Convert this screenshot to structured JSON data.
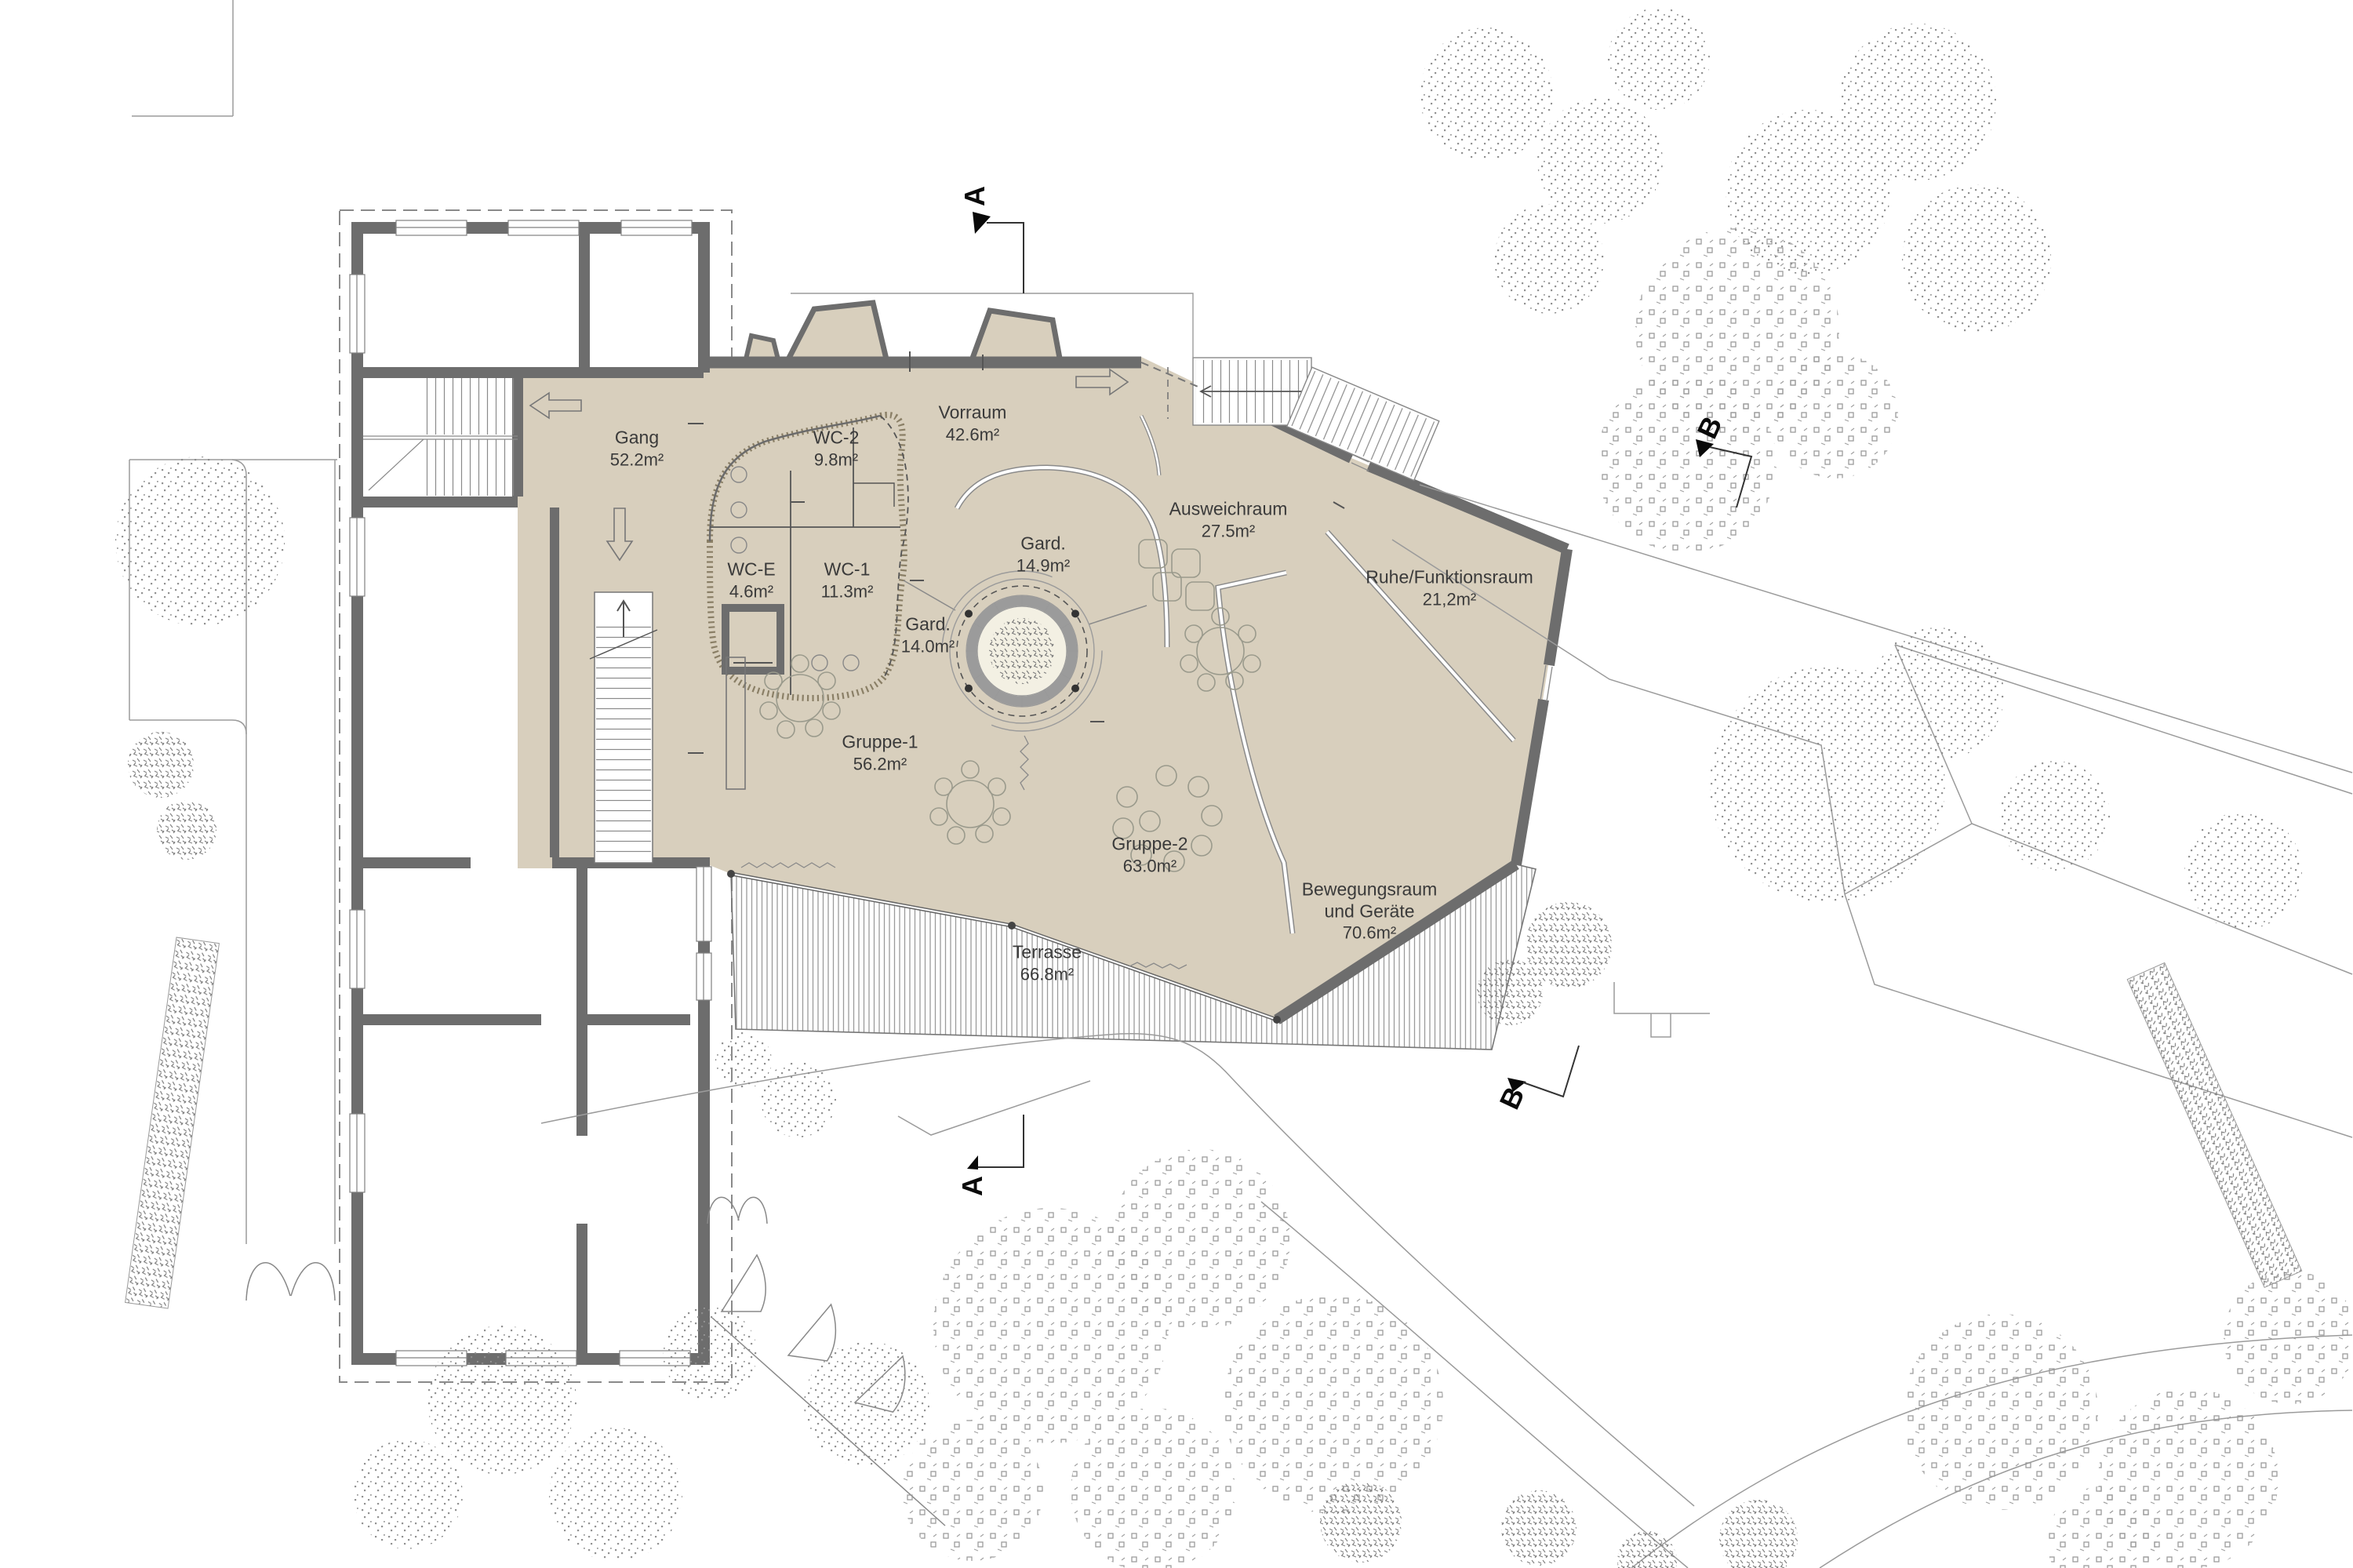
{
  "rooms": [
    {
      "name": "Gang",
      "name2": "",
      "area": "52.2m²"
    },
    {
      "name": "WC-2",
      "name2": "",
      "area": "9.8m²"
    },
    {
      "name": "WC-E",
      "name2": "",
      "area": "4.6m²"
    },
    {
      "name": "WC-1",
      "name2": "",
      "area": "11.3m²"
    },
    {
      "name": "Gard.",
      "name2": "",
      "area": "14.0m²"
    },
    {
      "name": "Gard.",
      "name2": "",
      "area": "14.9m²"
    },
    {
      "name": "Vorraum",
      "name2": "",
      "area": "42.6m²"
    },
    {
      "name": "Ausweichraum",
      "name2": "",
      "area": "27.5m²"
    },
    {
      "name": "Ruhe/Funktionsraum",
      "name2": "",
      "area": "21,2m²"
    },
    {
      "name": "Gruppe-1",
      "name2": "",
      "area": "56.2m²"
    },
    {
      "name": "Gruppe-2",
      "name2": "",
      "area": "63.0m²"
    },
    {
      "name": "Bewegungsraum",
      "name2": "und Geräte",
      "area": "70.6m²"
    },
    {
      "name": "Terrasse",
      "name2": "",
      "area": "66.8m²"
    }
  ],
  "markers": {
    "a": "A",
    "b": "B"
  },
  "colors": {
    "floor_beige": "#d8cfbd",
    "wall_gray": "#6d6d6d",
    "atrium_cream": "#f3f0e3",
    "thin_line": "#9b9b9b",
    "vegetation": "#8c8c8c"
  }
}
